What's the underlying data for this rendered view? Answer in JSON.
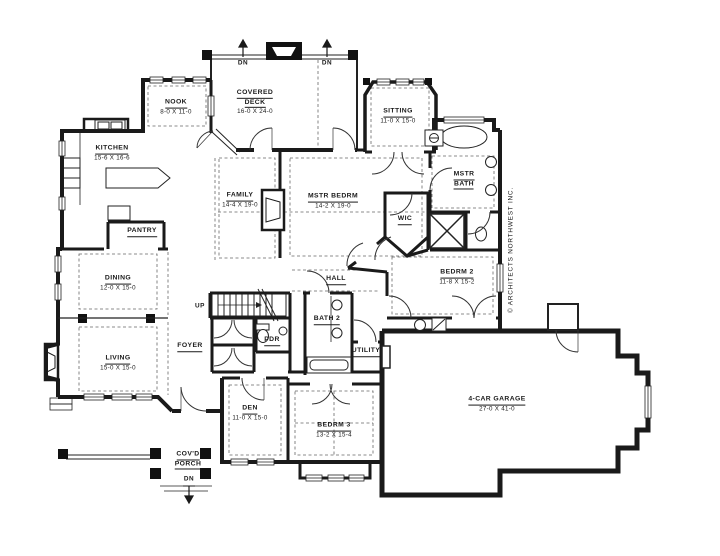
{
  "colors": {
    "ink": "#1a1a1a",
    "paper": "#ffffff"
  },
  "copyright": "© ARCHITECTS NORTHWEST INC.",
  "markers": {
    "up": "UP",
    "dn": "DN"
  },
  "rooms": [
    {
      "name": "NOOK",
      "dims": "8-0 X 11-0"
    },
    {
      "name": "COVERED",
      "name2": "DECK",
      "dims": "16-0 X 24-0"
    },
    {
      "name": "SITTING",
      "dims": "11-0 X 15-0"
    },
    {
      "name": "KITCHEN",
      "dims": "15-6 X 16-6"
    },
    {
      "name": "MSTR",
      "name2": "BATH"
    },
    {
      "name": "FAMILY",
      "dims": "14-4 X 19-0"
    },
    {
      "name": "MSTR BEDRM",
      "dims": "14-2 X 19-0"
    },
    {
      "name": "WIC"
    },
    {
      "name": "PANTRY"
    },
    {
      "name": "DINING",
      "dims": "12-0 X 15-0"
    },
    {
      "name": "HALL"
    },
    {
      "name": "BEDRM 2",
      "dims": "11-8 X 15-2"
    },
    {
      "name": "BATH 2"
    },
    {
      "name": "PDR"
    },
    {
      "name": "FOYER"
    },
    {
      "name": "UTILITY"
    },
    {
      "name": "LIVING",
      "dims": "15-0 X 15-0"
    },
    {
      "name": "DEN",
      "dims": "11-0 X 15-0"
    },
    {
      "name": "4-CAR GARAGE",
      "dims": "27-0 X 41-0"
    },
    {
      "name": "BEDRM 3",
      "dims": "13-2 X 15-4"
    },
    {
      "name": "COV'D",
      "name2": "PORCH"
    }
  ]
}
